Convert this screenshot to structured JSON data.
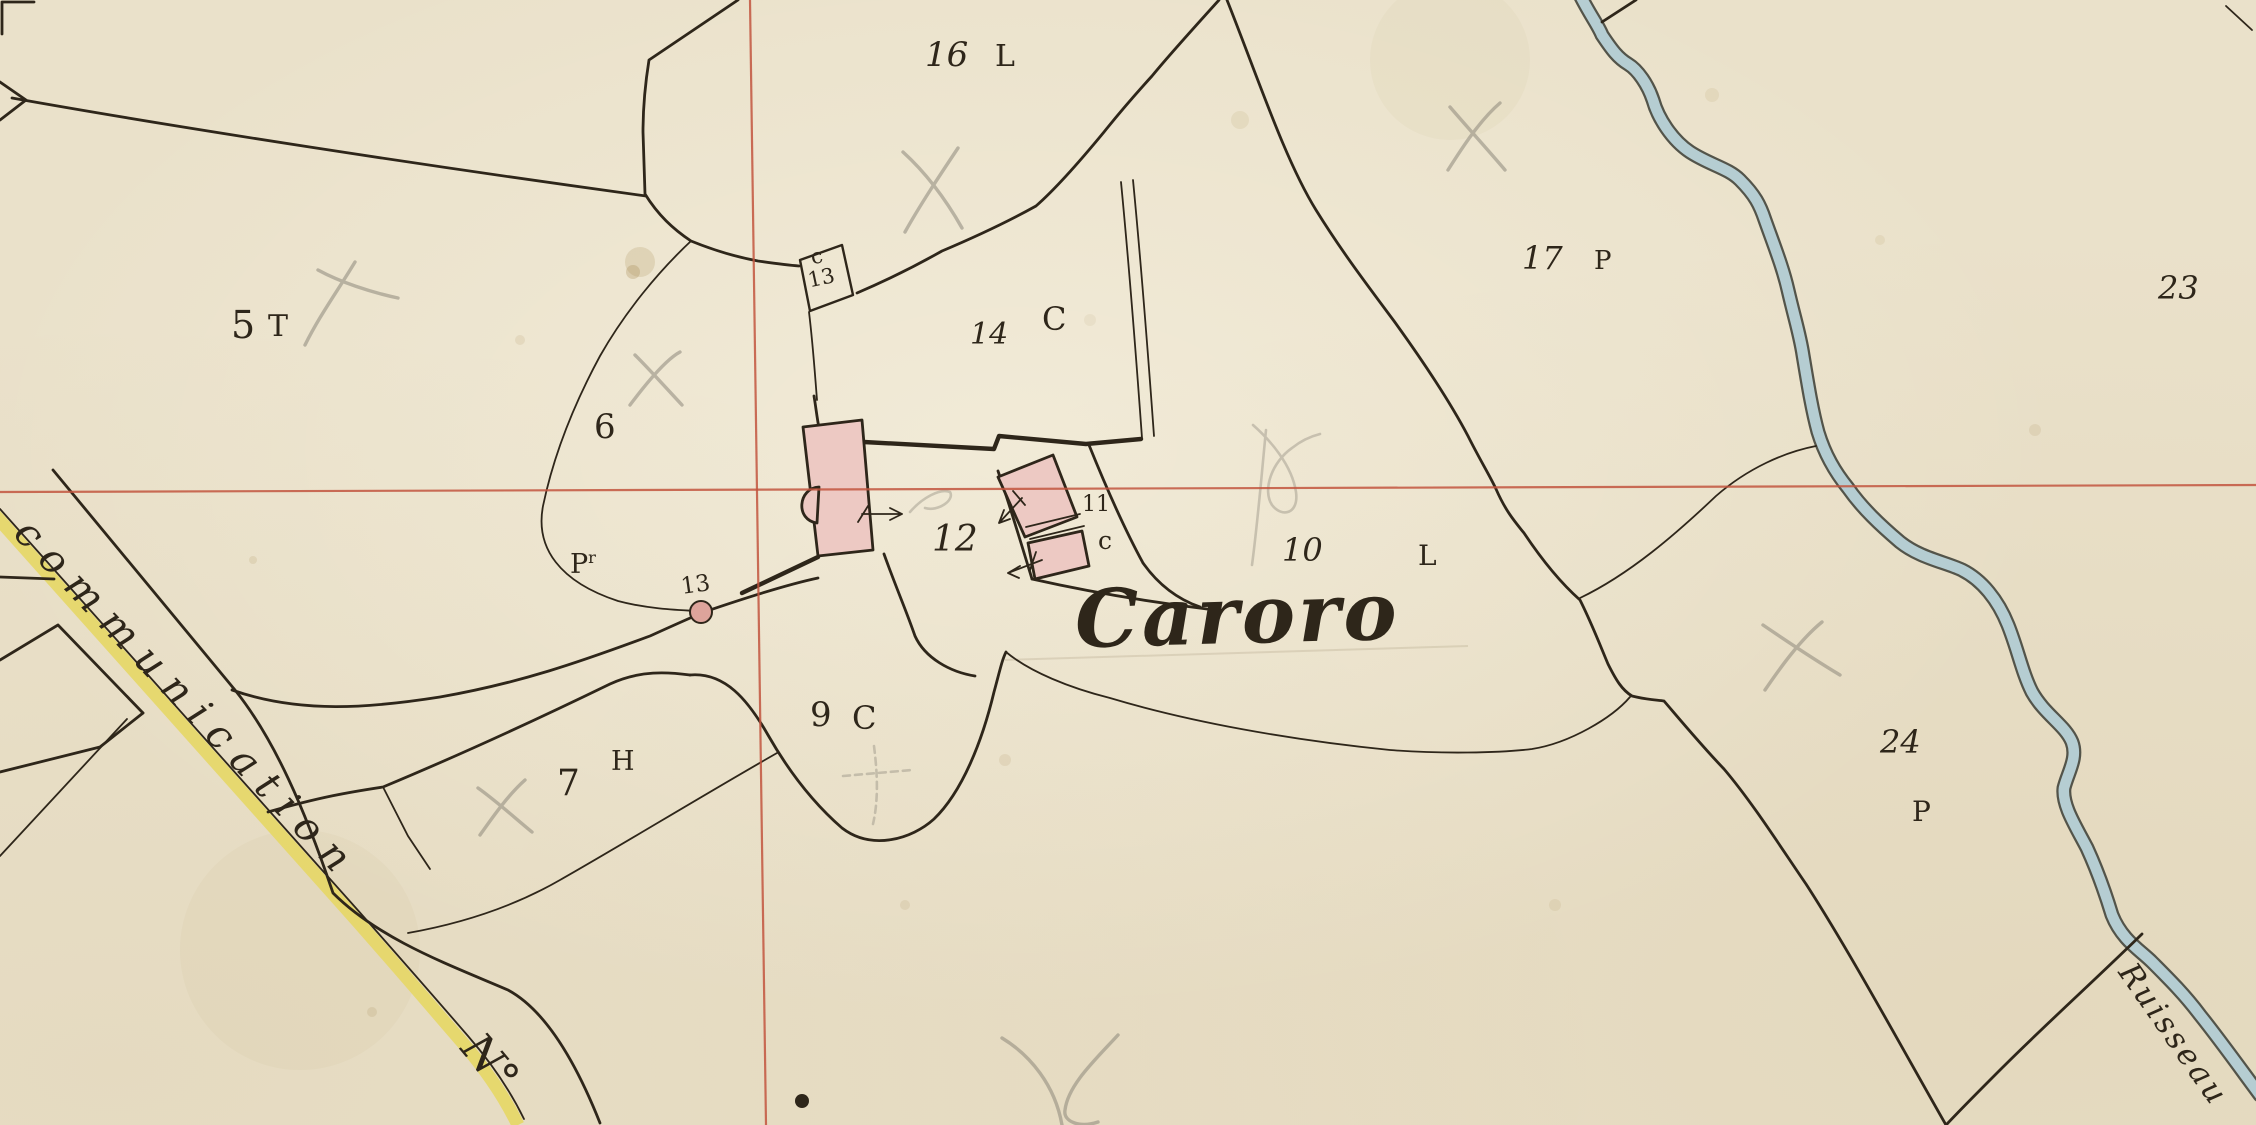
{
  "map": {
    "place_name": "Caroro",
    "road_name": "communication",
    "road_no": "N°",
    "stream_name": "Ruisseau",
    "parcels": {
      "p5": {
        "num": "5",
        "code": "T"
      },
      "p6": {
        "num": "6",
        "code": ""
      },
      "p7": {
        "num": "7",
        "code": "H"
      },
      "p9": {
        "num": "9",
        "code": "C"
      },
      "p10": {
        "num": "10",
        "code": "L"
      },
      "p11": {
        "num": "11",
        "code": "c"
      },
      "p12": {
        "num": "12",
        "code": ""
      },
      "p13_road_point": {
        "num": "13",
        "code": ""
      },
      "p13_building": {
        "num": "13",
        "code": "c"
      },
      "p14": {
        "num": "14",
        "code": "C"
      },
      "p16": {
        "num": "16",
        "code": "L"
      },
      "p17": {
        "num": "17",
        "code": "P"
      },
      "p23": {
        "num": "23",
        "code": ""
      },
      "p24": {
        "num": "24",
        "code": "P"
      },
      "p_annex": {
        "num": "P",
        "code": "r"
      }
    },
    "colors": {
      "paper": "#eae1ca",
      "ink": "#2e261a",
      "grid_red": "#c2553e",
      "road_yellow": "#e6d765",
      "water_fill": "#b5cdd2",
      "water_edge": "#53544a",
      "building_pink": "#edc9c3",
      "dot_pink": "#dda49b",
      "pencil": "#8d877a"
    }
  }
}
